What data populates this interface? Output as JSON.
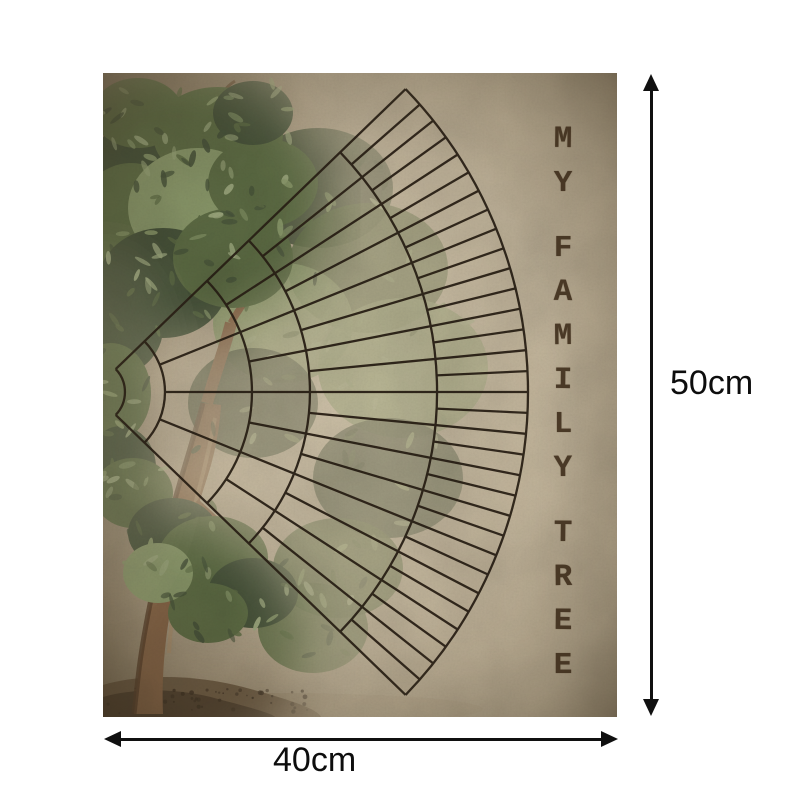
{
  "page": {
    "background": "#ffffff",
    "description": "Product image: blank genealogy fan chart poster with size annotations"
  },
  "poster": {
    "title": "MY FAMILY TREE",
    "title_words": [
      [
        "M",
        "Y"
      ],
      [
        "F",
        "A",
        "M",
        "I",
        "L",
        "Y"
      ],
      [
        "T",
        "R",
        "E",
        "E"
      ]
    ],
    "fan_chart": {
      "type": "genealogy-fan",
      "orientation": "opens-right",
      "center": {
        "x": -11,
        "y": 319
      },
      "ring_radii": [
        33,
        73,
        160,
        218,
        345,
        436
      ],
      "cells_per_ring": [
        1,
        4,
        8,
        16,
        32
      ],
      "span_degrees": 88,
      "line_width": 2.3,
      "cells_are_blank": true
    },
    "colors": {
      "parchment_base": "#c6b79d",
      "parchment_light": "#d8cbb0",
      "parchment_dark": "#a2927a",
      "vignette": "#5c4d36",
      "chart_line": "#2a2015",
      "title_text": "#3c2b19",
      "wash": "#d8cbb0",
      "foliage_dark": "#46543a",
      "foliage_mid": "#5f7046",
      "foliage_light": "#8fa06f",
      "foliage_pale": "#a3b184",
      "trunk": "#8a6748",
      "trunk_dark": "#59402a",
      "trunk_light": "#b2946f",
      "ground": "#6d5b43",
      "ground_dark": "#4e3f2d",
      "ground_shadow": "#8d7c5f"
    }
  },
  "dimensions": {
    "height": {
      "label": "50cm"
    },
    "width": {
      "label": "40cm"
    }
  }
}
